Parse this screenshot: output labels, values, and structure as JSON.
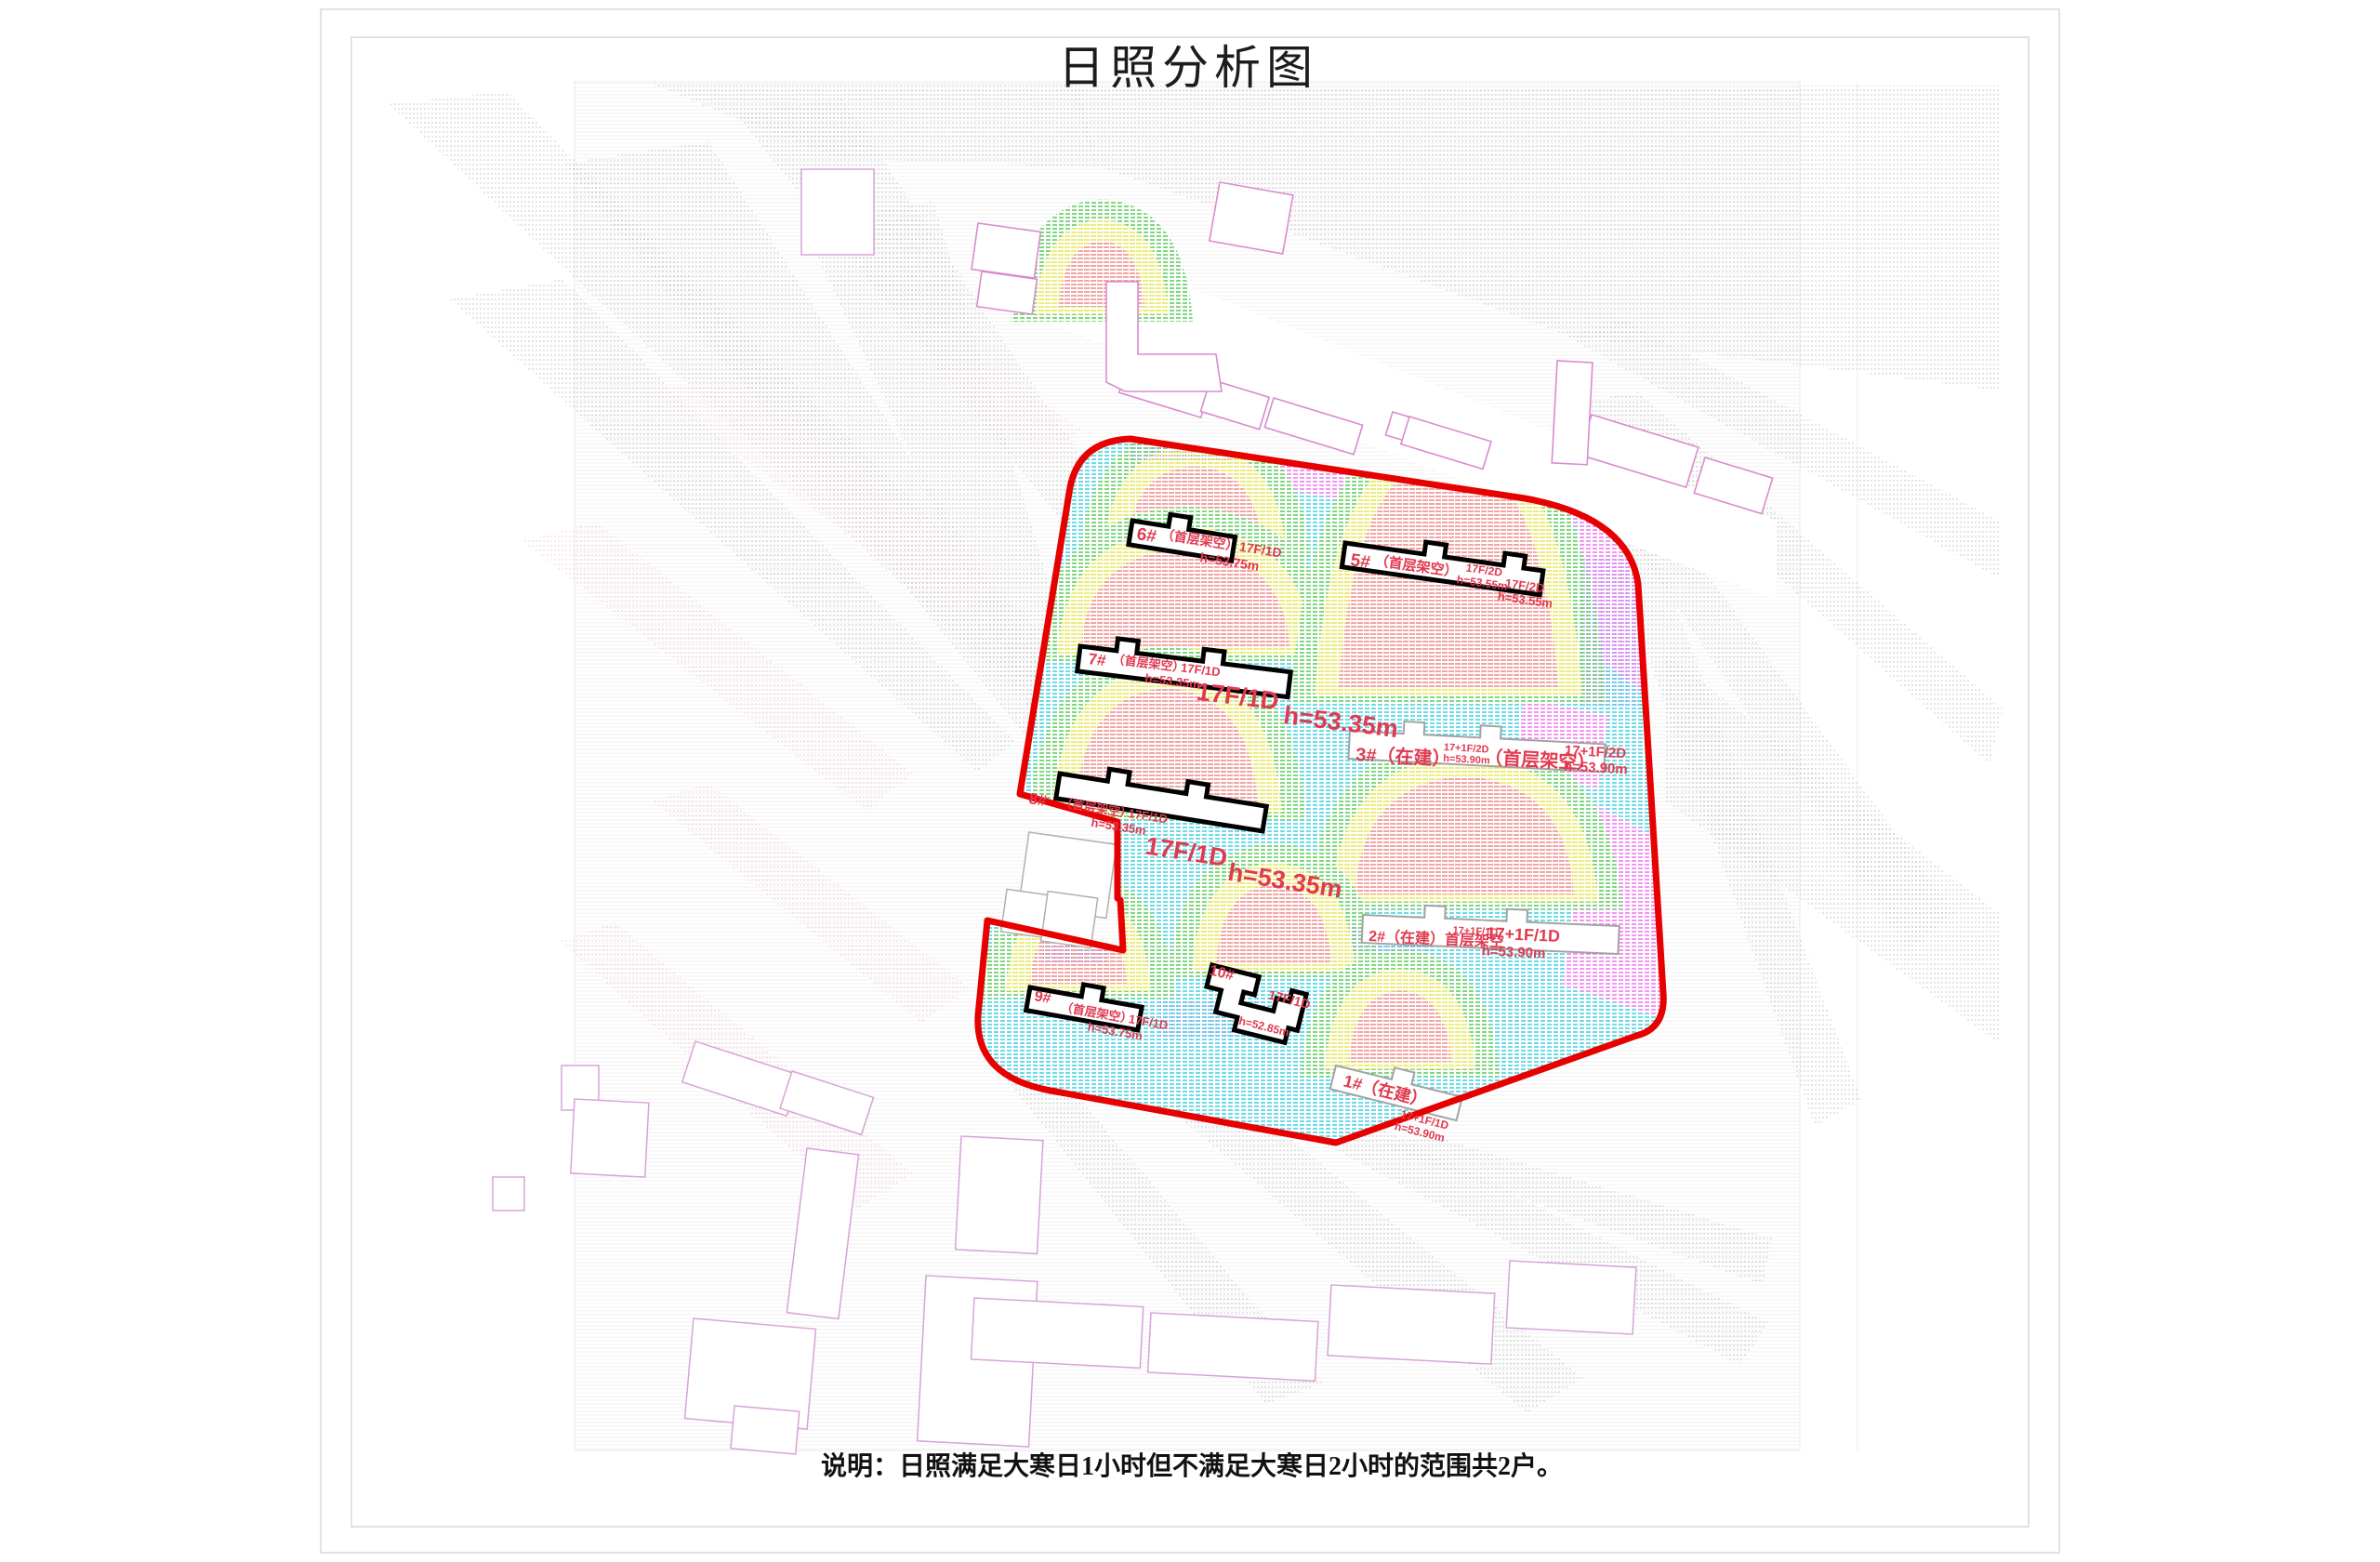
{
  "page": {
    "title": "日照分析图",
    "note": "说明：日照满足大寒日1小时但不满足大寒日2小时的范围共2户。"
  },
  "colors": {
    "boundary": "#e60000",
    "label": "#e03a50",
    "cyan": "#3ecfdd",
    "green": "#55cb55",
    "yellow": "#e6e650",
    "red": "#ee8787",
    "magenta": "#ee74ee",
    "blue": "#7b7bee",
    "gray": "#a5a5a5",
    "pink": "#eaa3cb",
    "existing_outline": "#d98bd0",
    "construction_outline": "#a3a3a3",
    "building_outline": "#000000"
  },
  "buildings": [
    {
      "name": "1#（在建）",
      "spec": "17+1F/1D",
      "height": "h=53.90m"
    },
    {
      "name": "2#（在建）首层架空",
      "spec_small": "17+1F/1D",
      "spec": "17+1F/1D",
      "height": "h=53.90m"
    },
    {
      "name": "3#（在建）",
      "spec_small": "17+1F/2D",
      "height_small": "h=53.90m",
      "paren": "（首层架空）",
      "spec": "17+1F/2D",
      "height": "h=53.90m"
    },
    {
      "name": "5#",
      "paren": "（首层架空）",
      "spec": "17F/2D",
      "height": "h=53.55m"
    },
    {
      "name": "6#",
      "paren": "（首层架空）",
      "spec": "17F/1D",
      "height": "h=53.75m"
    },
    {
      "name": "7#",
      "paren": "（首层架空）",
      "spec": "17F/1D",
      "height": "h=53.35m",
      "spec_big": "17F/1D",
      "height_big": "h=53.35m"
    },
    {
      "name": "8#",
      "paren": "（首层架空）",
      "spec": "17F/1D",
      "height": "h=53.35m",
      "spec_big": "17F/1D",
      "height_big": "h=53.35m"
    },
    {
      "name": "9#",
      "paren": "（首层架空）",
      "spec": "17F/1D",
      "height": "h=53.75m"
    },
    {
      "name": "10#",
      "spec": "17F/1D",
      "height": "h=52.85m"
    }
  ]
}
